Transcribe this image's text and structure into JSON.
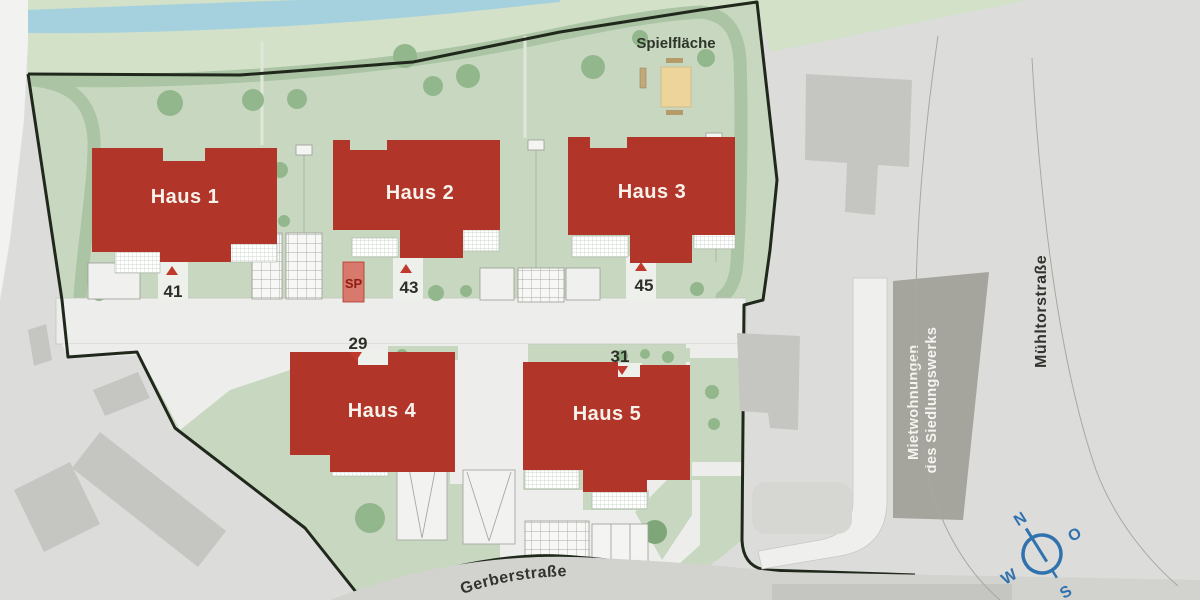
{
  "site": {
    "houses": [
      {
        "label": "Haus 1"
      },
      {
        "label": "Haus 2"
      },
      {
        "label": "Haus 3"
      },
      {
        "label": "Haus 4"
      },
      {
        "label": "Haus 5"
      }
    ],
    "entrances": {
      "e41": "41",
      "e43": "43",
      "e45": "45",
      "e29": "29",
      "e31": "31"
    },
    "sp_label": "SP",
    "playground_label": "Spielfläche"
  },
  "streets": {
    "gerberstrasse": "Gerberstraße",
    "muehltorstrasse": "Mühltorstraße"
  },
  "neighbor_building": {
    "line1": "Mietwohnungen",
    "line2": "des Siedlungswerks"
  },
  "compass": {
    "north": "N",
    "east": "O",
    "south": "S",
    "west": "W"
  },
  "colors": {
    "background_gray": "#dcdcda",
    "site_lawn_green": "#c8d8c0",
    "bank_green": "#d3e1c9",
    "path_band_green": "#aac4a4",
    "river_blue": "#a5d1de",
    "new_building_red": "#b23529",
    "sp_box_red": "#d8796d",
    "triangle_red": "#c0392b",
    "existing_building_gray": "#c5c5c2",
    "neighbor_building_gray": "#a5a59d",
    "paved_white": "#eff0ee",
    "road_gray": "#d2d2cf",
    "boundary_dark": "#20281c",
    "sand_tan": "#ecd49b",
    "compass_blue": "#2f72ae"
  }
}
